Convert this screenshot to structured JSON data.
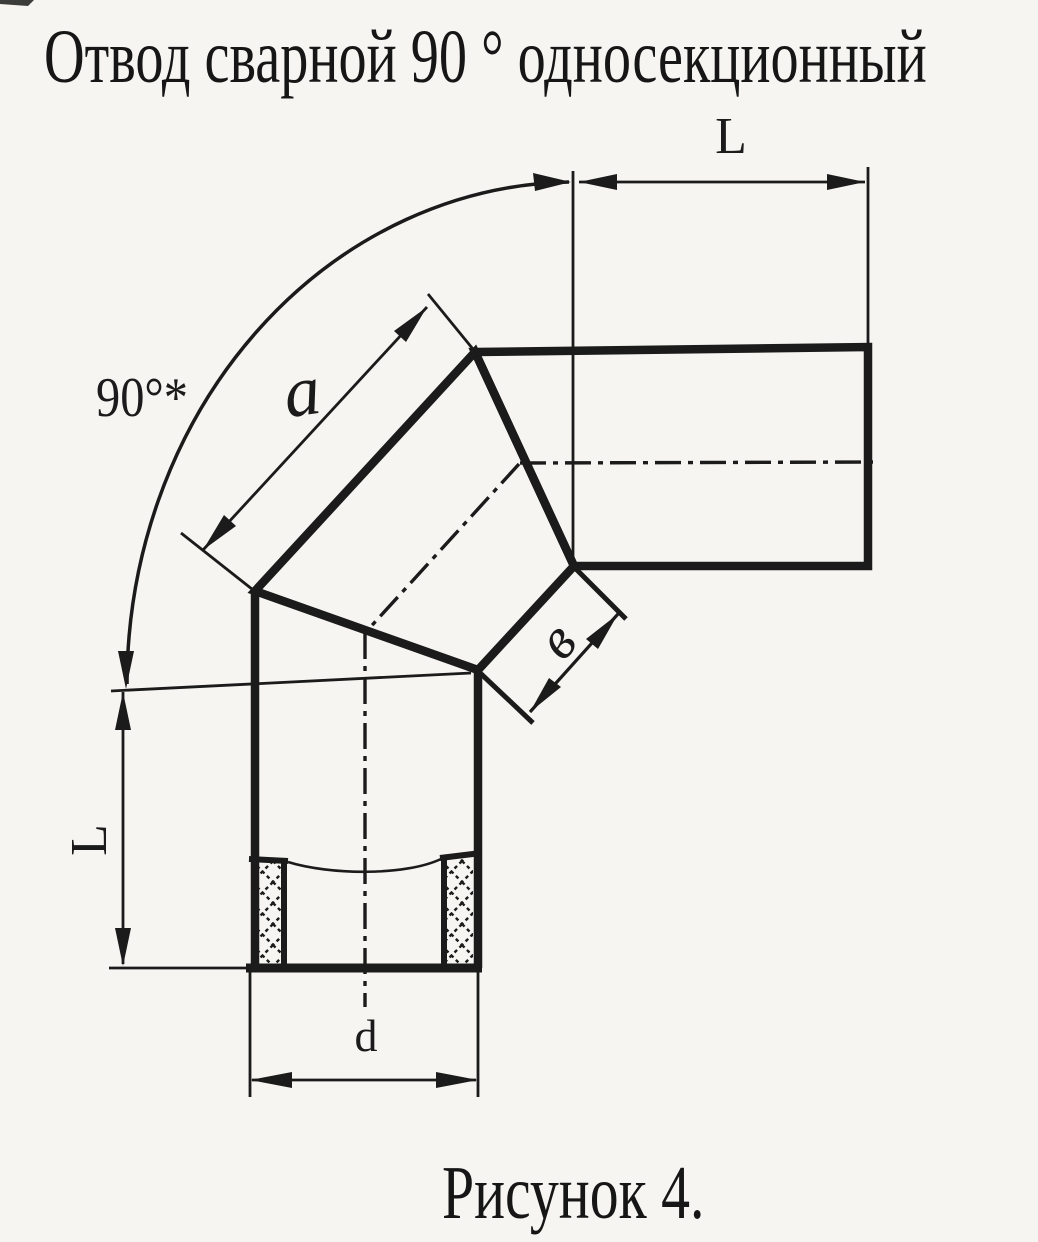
{
  "page": {
    "title": "Отвод сварной 90 ° односекционный",
    "caption": "Рисунок 4."
  },
  "drawing": {
    "labels": {
      "length_top": "L",
      "length_left": "L",
      "section_side": "a",
      "miter_width": "в",
      "diameter": "d",
      "angle": "90°*"
    },
    "colors": {
      "ink": "#1b1b1b",
      "paper": "#f6f5f2"
    }
  }
}
